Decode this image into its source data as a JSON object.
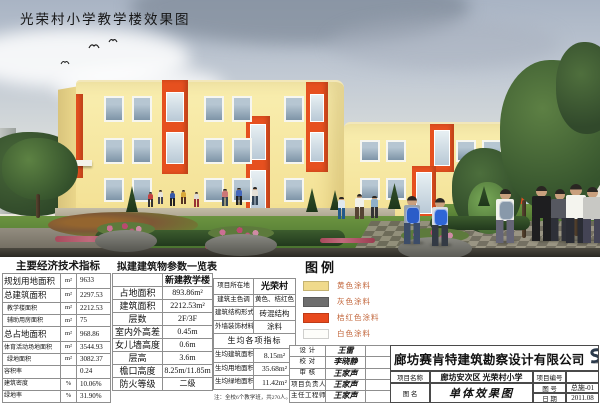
{
  "sheet": {
    "title": "光荣村小学教学楼效果图"
  },
  "econ": {
    "title": "主要经济技术指标",
    "rows": [
      {
        "label": "规划用地面积",
        "unit": "m²",
        "value": "9633"
      },
      {
        "label": "总建筑面积",
        "unit": "m²",
        "value": "2297.53"
      },
      {
        "label": "教学楼面积",
        "unit": "m²",
        "value": "2212.53"
      },
      {
        "label": "辅助用房面积",
        "unit": "m²",
        "value": "75"
      },
      {
        "label": "总占地面积",
        "unit": "m²",
        "value": "968.86"
      },
      {
        "label": "体育活动场地面积",
        "unit": "m²",
        "value": "3544.93"
      },
      {
        "label": "绿地面积",
        "unit": "m²",
        "value": "3082.37"
      },
      {
        "label": "容积率",
        "unit": "",
        "value": "0.24"
      },
      {
        "label": "建筑密度",
        "unit": "%",
        "value": "10.06%"
      },
      {
        "label": "绿地率",
        "unit": "%",
        "value": "31.90%"
      }
    ]
  },
  "params": {
    "title": "拟建建筑物参数一览表",
    "col_header": "新建教学楼",
    "rows": [
      {
        "label": "占地面积",
        "value": "893.86m²"
      },
      {
        "label": "建筑面积",
        "value": "2212.53m²"
      },
      {
        "label": "层数",
        "value": "2F/3F"
      },
      {
        "label": "室内外高差",
        "value": "0.45m"
      },
      {
        "label": "女儿墙高度",
        "value": "0.6m"
      },
      {
        "label": "层高",
        "value": "3.6m"
      },
      {
        "label": "檐口高度",
        "value": "8.25m/11.85m"
      },
      {
        "label": "防火等级",
        "value": "二级"
      }
    ]
  },
  "info": {
    "rows": [
      {
        "label": "项目所在地",
        "value": "光荣村"
      },
      {
        "label": "建筑主色调",
        "value": "黄色、桔红色"
      },
      {
        "label": "建筑结构形式",
        "value": "砖混结构"
      },
      {
        "label": "外墙装饰材料",
        "value": "涂料"
      }
    ],
    "per_header": "生均各项指标",
    "per_rows": [
      {
        "label": "生均建筑面积",
        "value": "8.15m²"
      },
      {
        "label": "生均用地面积",
        "value": "35.68m²"
      },
      {
        "label": "生均绿地面积",
        "value": "11.42m²"
      }
    ],
    "note": "注：全校6个教学班，共270人。"
  },
  "legend": {
    "title": "图例",
    "items": [
      {
        "label": "黄色涂料",
        "color": "#f0da8c"
      },
      {
        "label": "灰色涂料",
        "color": "#6e6e6e"
      },
      {
        "label": "桔红色涂料",
        "color": "#e8491d"
      },
      {
        "label": "白色涂料",
        "color": "#fdfdfa"
      }
    ]
  },
  "titleblock": {
    "signatures": [
      {
        "label": "设  计",
        "name": "王雷"
      },
      {
        "label": "校  对",
        "name": "李晓静"
      },
      {
        "label": "审  核",
        "name": "王家声"
      },
      {
        "label": "项目负责人",
        "name": "王家声"
      },
      {
        "label": "主任工程师",
        "name": "王家声"
      }
    ],
    "company": "廊坊赛肯特建筑勘察设计有限公司",
    "project_name_label": "项目名称",
    "project_name": "廊坊安次区 光荣村小学",
    "project_no_label": "项目编号",
    "drawing_name_label": "图  名",
    "drawing_name": "单体效果图",
    "drawing_no_label": "图  号",
    "drawing_no": "总施-01",
    "date_label": "日  期",
    "date": "2011.08"
  }
}
